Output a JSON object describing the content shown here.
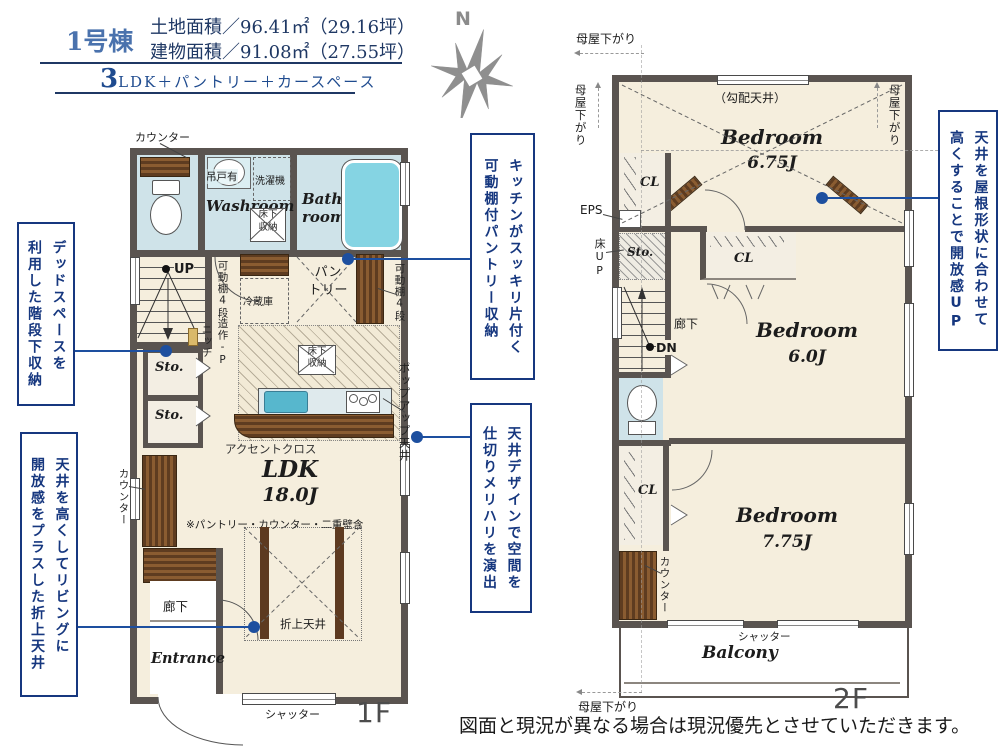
{
  "header": {
    "building_no": "1号棟",
    "land_area": "土地面積／96.41㎡（29.16坪）",
    "building_area": "建物面積／91.08㎡（27.55坪）",
    "layout_prefix": "3",
    "layout_rest": "LDK＋パントリー＋カースペース"
  },
  "compass": {
    "north_label": "N"
  },
  "annotations": [
    {
      "text": "デッドスペースを\n利用した階段下収納"
    },
    {
      "text": "天井を高くしてリビングに\n開放感をプラスした折上天井"
    },
    {
      "text": "キッチンがスッキリ片付く\n可動棚付パントリー収納"
    },
    {
      "text": "天井デザインで空間を\n仕切りメリハリを演出"
    },
    {
      "text": "天井を屋根形状に合わせて\n高くすることで開放感UP"
    }
  ],
  "floor1": {
    "floor_label": "1F",
    "rooms": {
      "washroom": "Washroom",
      "bathroom": "Bath\nroom",
      "ldk_name": "LDK",
      "ldk_size": "18.0J",
      "entrance": "Entrance",
      "hallway": "廊下",
      "storage1": "Sto.",
      "storage2": "Sto.",
      "pantry": "パン\nトリー"
    },
    "labels": {
      "counter_top": "カウンター",
      "counter_left": "カウンター",
      "hanging_cupboard": "吊戸有",
      "washing_machine": "洗濯機",
      "underfloor_storage_washroom": "床下\n収納",
      "underfloor_storage_kitchen": "床下\n収納",
      "up": "UP",
      "movable_shelf_left": "可動棚4段",
      "movable_shelf_right": "可動棚4段",
      "builtin_p": "造作-P",
      "niche": "ニッチ",
      "refrigerator": "冷蔵庫",
      "accent_cloth": "アクセントクロス",
      "ldk_note": "※パントリー・カウンター・二重壁含",
      "coffered_ceiling": "折上天井",
      "popup_ceiling": "ポップアップ天井",
      "shutter": "シャッター"
    }
  },
  "floor2": {
    "floor_label": "2F",
    "rooms": {
      "bedroom1_name": "Bedroom",
      "bedroom1_size": "6.75J",
      "bedroom2_name": "Bedroom",
      "bedroom2_size": "6.0J",
      "bedroom3_name": "Bedroom",
      "bedroom3_size": "7.75J",
      "balcony": "Balcony",
      "hallway": "廊下",
      "storage": "Sto.",
      "closet1": "CL",
      "closet2": "CL",
      "closet3": "CL"
    },
    "labels": {
      "sloped_ceiling": "（勾配天井）",
      "moya_top": "母屋下がり",
      "moya_left": "母屋下がり",
      "moya_right": "母屋下がり",
      "moya_bottom": "母屋下がり",
      "eps": "EPS",
      "floor_up": "床UP",
      "dn": "DN",
      "counter": "カウンター",
      "shutter": "シャッター"
    }
  },
  "footer": {
    "disclaimer": "図面と現況が異なる場合は現況優先とさせていただきます。"
  },
  "colors": {
    "accent_blue": "#1d4f9f",
    "annotation_blue": "#16377f",
    "wall_gray": "#5a5450",
    "room_cream": "#f5eedd",
    "wet_room_blue": "#cfe3e9",
    "wood_brown": "#5e3c20",
    "tub_cyan": "#85d4e3",
    "header_navy": "#1f3864"
  }
}
